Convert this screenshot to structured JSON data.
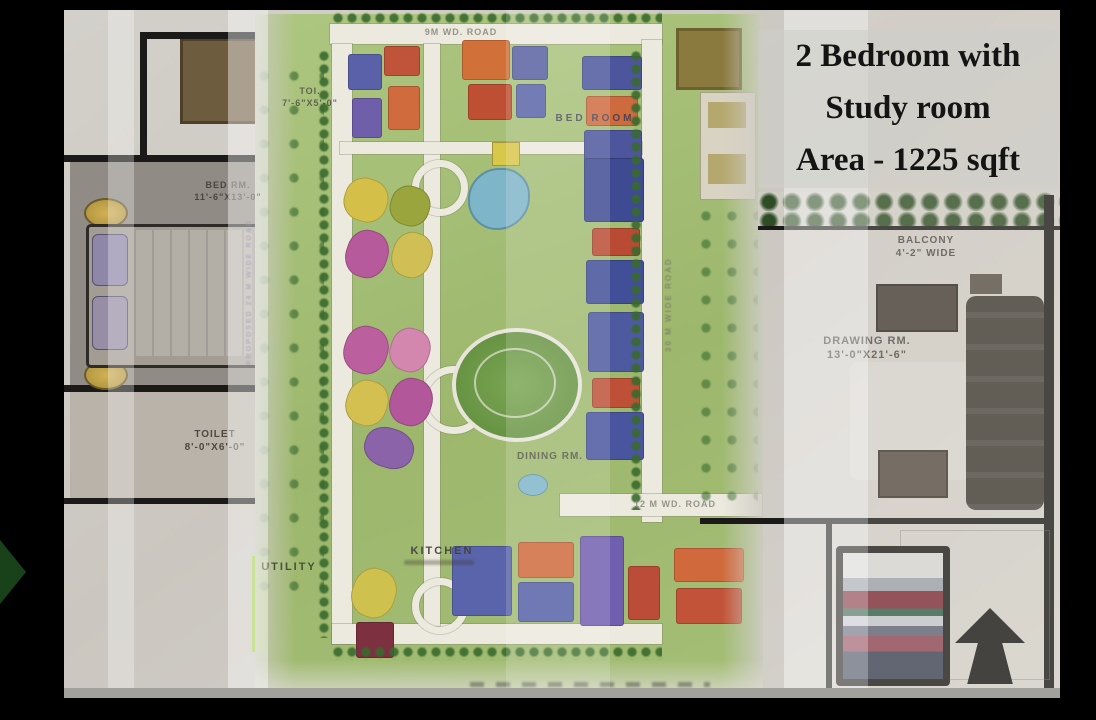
{
  "headline": {
    "line1": "2 Bedroom with",
    "line2": "Study room",
    "line3": "Area - 1225 sqft"
  },
  "floor_plan": {
    "bed_rm_left": {
      "label": "BED RM.",
      "dims": "11'-6\"X13'-0\""
    },
    "toilet_left": {
      "label": "TOILET",
      "dims": "8'-0\"X6'-0\""
    },
    "toilet_top": {
      "label": "TOI.",
      "dims": "7'-6\"X5'-0\""
    },
    "bed_room_top": {
      "label": "BED ROOM",
      "dims": ""
    },
    "dining": {
      "label": "DINING RM.",
      "dims": ""
    },
    "kitchen": {
      "label": "KITCHEN",
      "dims": ""
    },
    "utility": {
      "label": "UTILITY",
      "dims": ""
    },
    "drawing_rm": {
      "label": "DRAWING RM.",
      "dims": "13'-0\"X21'-6\""
    },
    "balcony": {
      "label": "BALCONY",
      "dims": "4'-2\" WIDE"
    }
  },
  "site_plan": {
    "road_top": "9M WD. ROAD",
    "road_mid": "12 M WD. ROAD",
    "road_right_vertical": "30 M WIDE ROAD",
    "road_left_vertical": "PROPOSED 24 M WIDE ROAD"
  },
  "colors": {
    "frame": "#000000",
    "plan_paper": "#d2cfc9",
    "site_green": "#a3bd74",
    "road_white": "#eceade",
    "building_blue": "#5a61a8",
    "building_orange": "#d06a3c",
    "building_red": "#c04f35",
    "building_magenta": "#b75a9b",
    "building_yellow": "#d3c050",
    "bed_maroon": "#7c2834"
  }
}
